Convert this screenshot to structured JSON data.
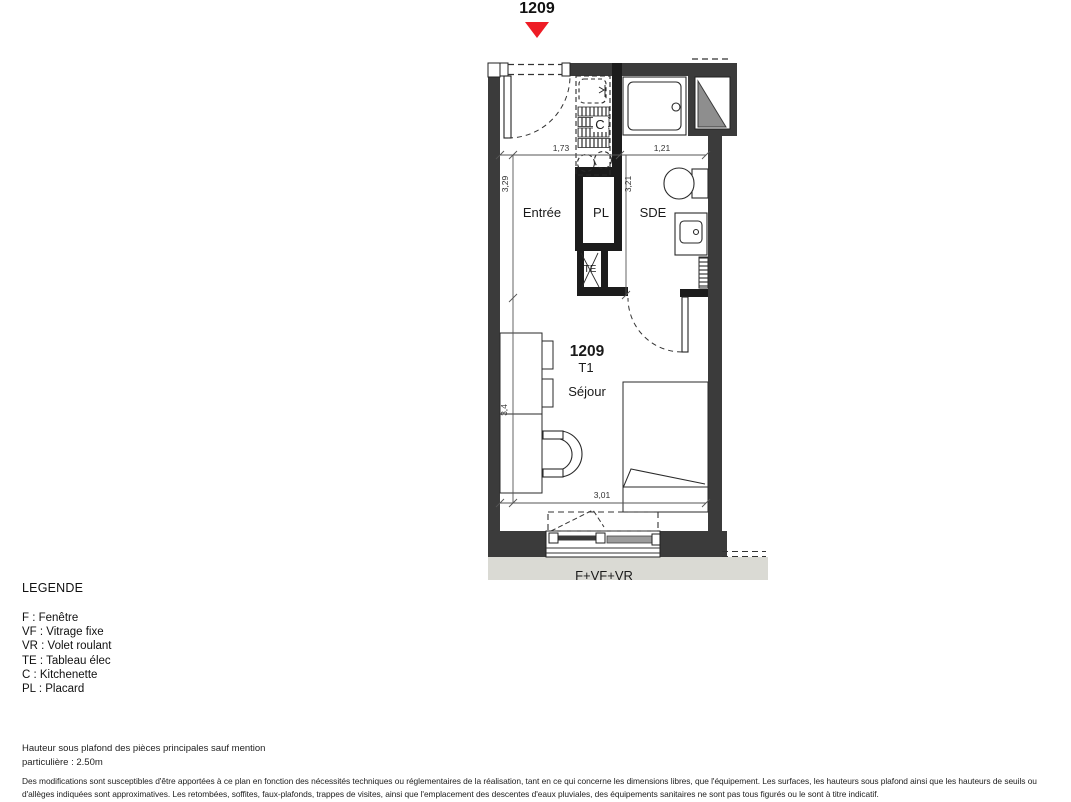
{
  "header": {
    "unit_number": "1209"
  },
  "plan": {
    "rooms": {
      "entree": "Entrée",
      "placard": "PL",
      "sde": "SDE",
      "sejour": "Séjour"
    },
    "unit": {
      "number": "1209",
      "type": "T1"
    },
    "labels": {
      "te": "TE",
      "kitchenette": "C",
      "window": "F+VF+VR"
    },
    "dimensions": {
      "width_entree": "1,73",
      "width_sde": "1,21",
      "depth_entree": "3,29",
      "depth_sde": "3,21",
      "depth_sejour": "3,4",
      "width_sejour": "3,01"
    },
    "colors": {
      "exterior_wall": "#3b3b3b",
      "partition": "#1c1c1c",
      "marker_red": "#ee1c25",
      "duct_gray": "#8e8e8e",
      "slab_gray": "#dadad4",
      "fixed_glazing_gray": "#9b9b9b"
    }
  },
  "legend": {
    "title": "LEGENDE",
    "items": [
      "F : Fenêtre",
      "VF : Vitrage fixe",
      "VR : Volet roulant",
      "TE : Tableau élec",
      "C : Kitchenette",
      "PL : Placard"
    ]
  },
  "footer": {
    "ceiling_note_line1": "Hauteur sous plafond des pièces principales sauf mention",
    "ceiling_note_line2": "particulière : 2.50m",
    "disclaimer_line1": "Des modifications sont susceptibles d'être apportées à ce plan en fonction des nécessités techniques ou réglementaires de la réalisation, tant en ce qui concerne les dimensions libres, que l'équipement. Les surfaces, les hauteurs sous plafond ainsi que les hauteurs de seuils ou",
    "disclaimer_line2": "d'allèges indiquées sont approximatives. Les retombées, soffites, faux-plafonds, trappes de visites, ainsi que l'emplacement des descentes d'eaux pluviales, des équipements sanitaires ne sont pas tous figurés ou le sont à titre indicatif."
  }
}
